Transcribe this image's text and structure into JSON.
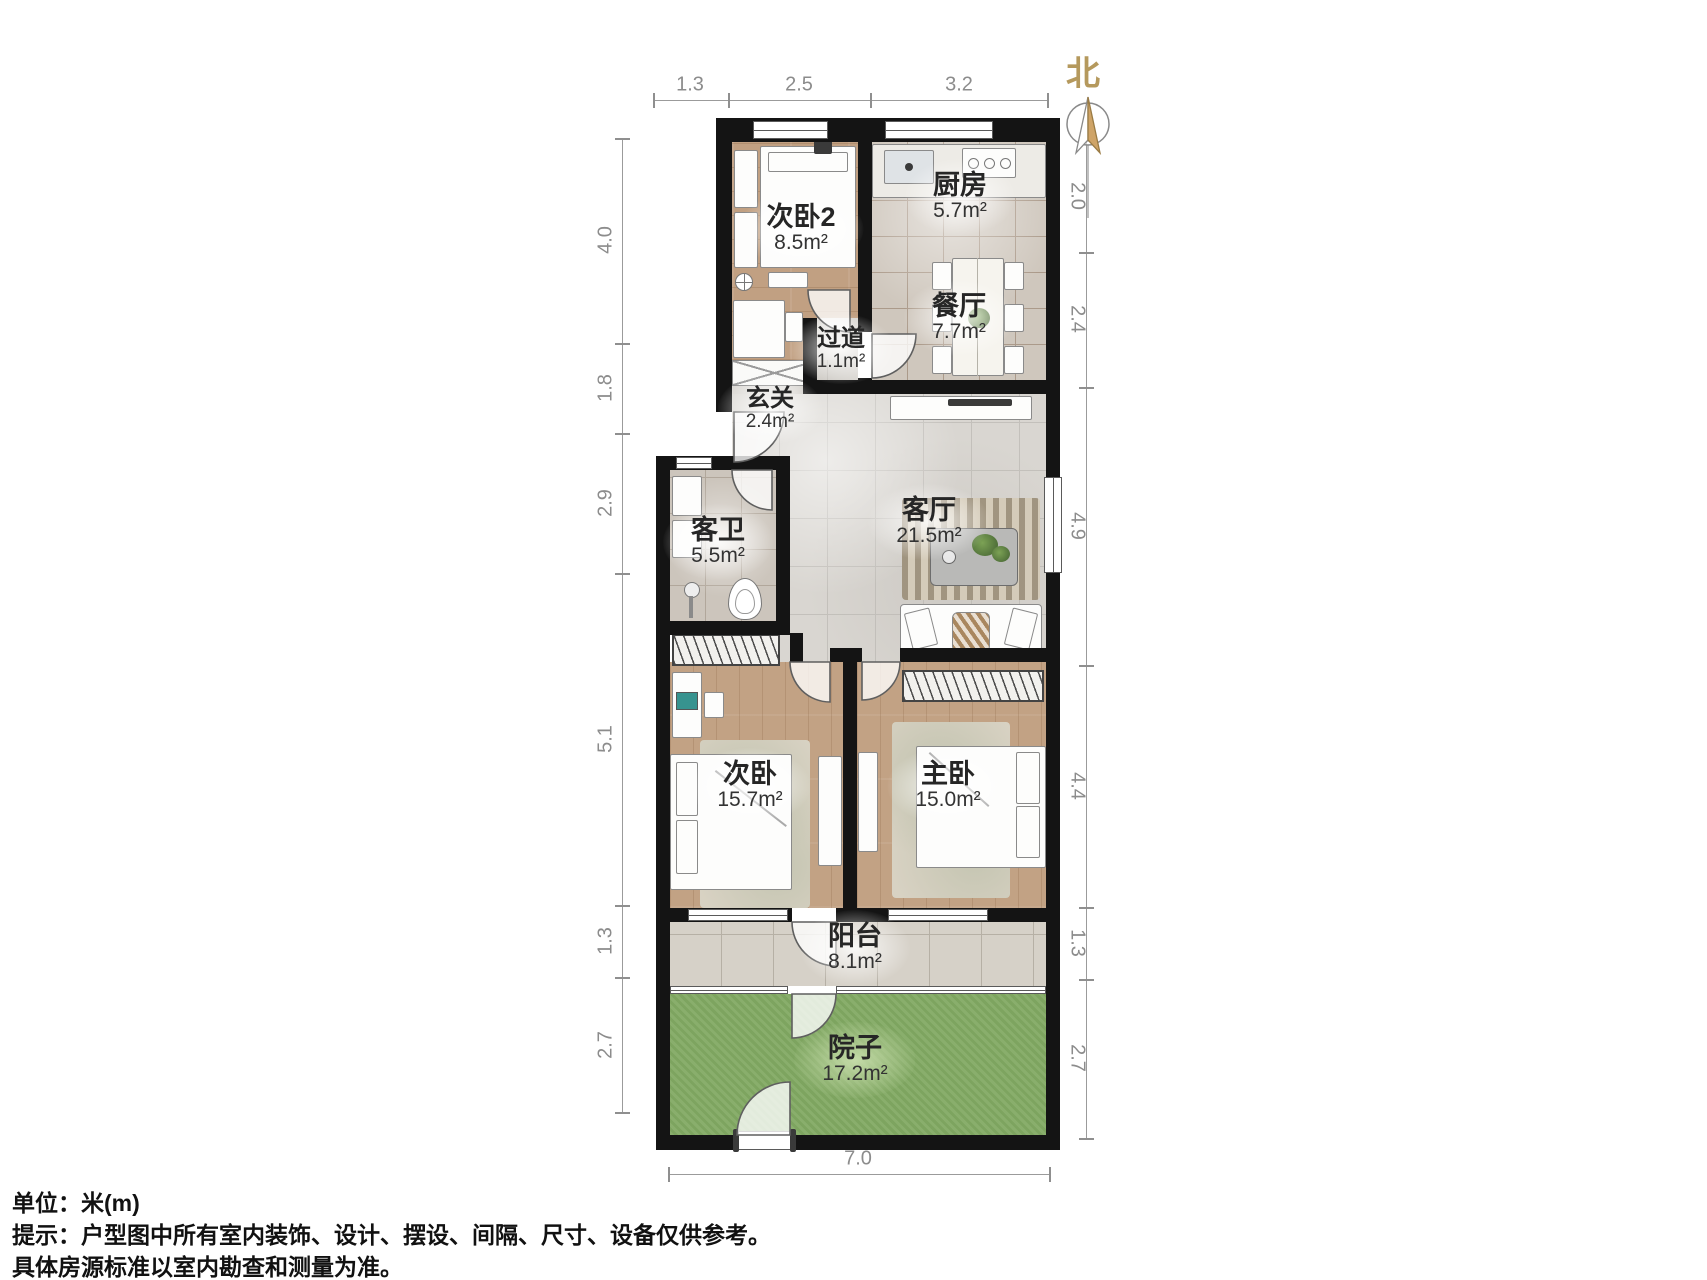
{
  "north": {
    "label": "北"
  },
  "rooms": [
    {
      "name": "次卧2",
      "area": "8.5m²"
    },
    {
      "name": "厨房",
      "area": "5.7m²"
    },
    {
      "name": "餐厅",
      "area": "7.7m²"
    },
    {
      "name": "过道",
      "area": "1.1m²"
    },
    {
      "name": "玄关",
      "area": "2.4m²"
    },
    {
      "name": "客卫",
      "area": "5.5m²"
    },
    {
      "name": "客厅",
      "area": "21.5m²"
    },
    {
      "name": "次卧",
      "area": "15.7m²"
    },
    {
      "name": "主卧",
      "area": "15.0m²"
    },
    {
      "name": "阳台",
      "area": "8.1m²"
    },
    {
      "name": "院子",
      "area": "17.2m²"
    }
  ],
  "dimensions": {
    "top": [
      "1.3",
      "2.5",
      "3.2"
    ],
    "left": [
      "4.0",
      "1.8",
      "2.9",
      "5.1",
      "1.3",
      "2.7"
    ],
    "right": [
      "2.0",
      "2.4",
      "4.9",
      "4.4",
      "1.3",
      "2.7"
    ],
    "bottom": [
      "7.0"
    ]
  },
  "footer": {
    "unit_note": "单位：米(m)",
    "tip_line1": "提示：户型图中所有室内装饰、设计、摆设、间隔、尺寸、设备仅供参考。",
    "tip_line2": "具体房源标准以室内勘查和测量为准。"
  },
  "colors": {
    "wall": "#141414",
    "grass": "#83aa64",
    "wood": "#c2a183",
    "hall_tile": "#d9d6d1",
    "kitchen_tile": "#cfc7bd",
    "north_tan": "#b5995d"
  }
}
